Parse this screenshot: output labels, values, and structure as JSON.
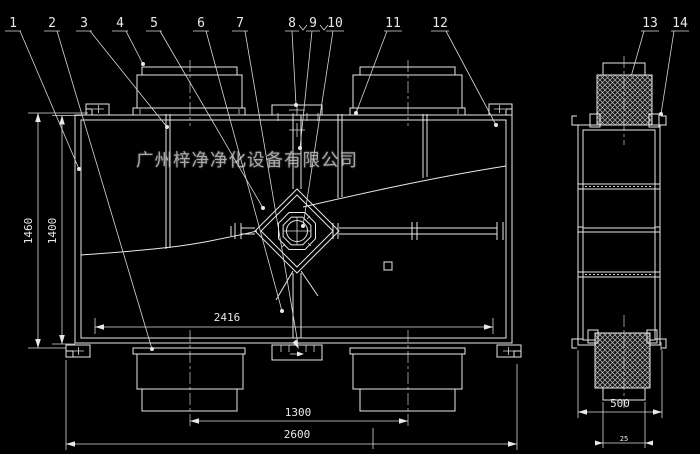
{
  "drawing": {
    "company_watermark": "广州梓净净化设备有限公司",
    "callouts": [
      "1",
      "2",
      "3",
      "4",
      "5",
      "6",
      "7",
      "8",
      "9",
      "10",
      "11",
      "12",
      "13",
      "14"
    ],
    "dimensions": {
      "height_outer": "1460",
      "height_inner": "1400",
      "inner_width": "2416",
      "port_spacing": "1300",
      "overall_width": "2600",
      "side_width": "500",
      "side_flange": "25"
    },
    "colors": {
      "background": "#000000",
      "line": "#e8e8e8",
      "watermark": "#c6c6c6"
    }
  }
}
